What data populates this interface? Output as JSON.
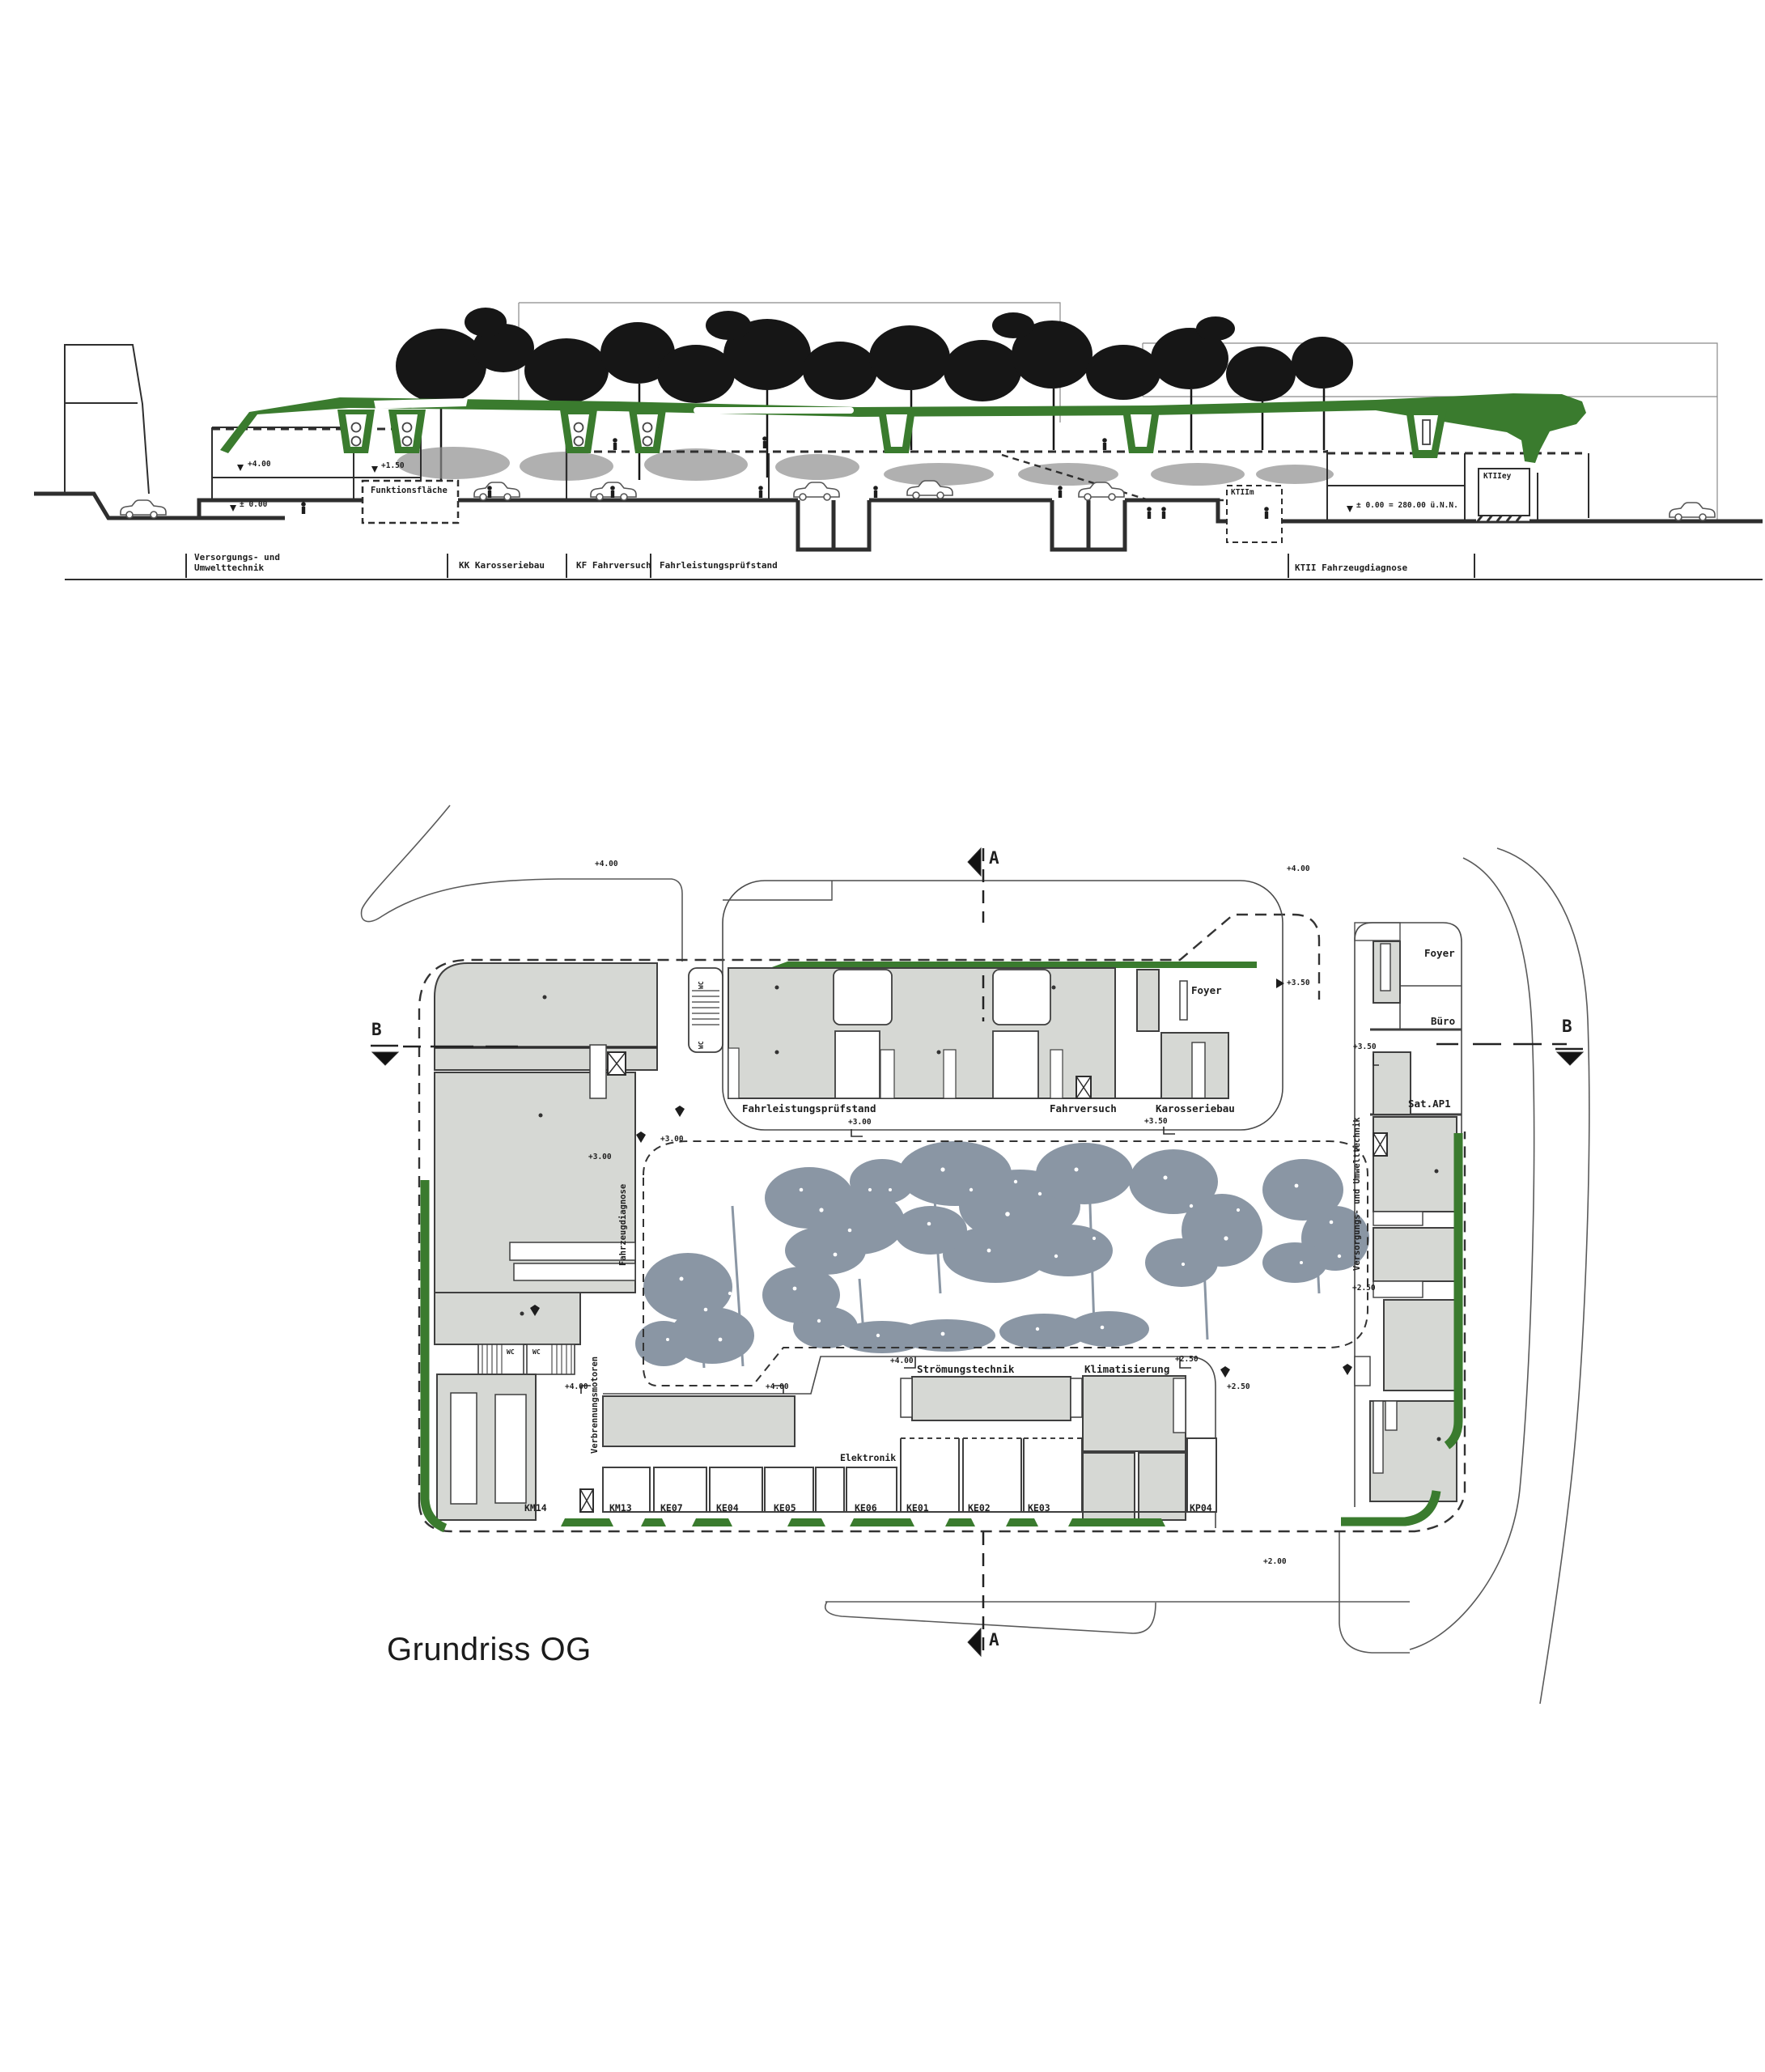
{
  "title": "Grundriss OG",
  "colors": {
    "green": "#3a7b2e",
    "building_gray": "#d6d8d4",
    "tree_gray": "#8a96a4",
    "line": "#2e2e2e"
  },
  "section": {
    "zones": [
      {
        "label": "Versorgungs- und Umwelttechnik"
      },
      {
        "label": "KK Karosseriebau"
      },
      {
        "label": "KF Fahrversuch"
      },
      {
        "label": "Fahrleistungsprüfstand"
      },
      {
        "label": "KTII Fahrzeugdiagnose"
      }
    ],
    "rooms": {
      "funktionsflaeche": "Funktionsfläche",
      "ktii_m": "KTIIm",
      "ktii_ey": "KTIIey"
    },
    "elevations": {
      "plus400": "+4.00",
      "plus150": "+1.50",
      "zero": "± 0.00",
      "datum": "± 0.00 = 280.00 ü.N.N."
    }
  },
  "plan": {
    "section_markers": {
      "a": "A",
      "b": "B"
    },
    "top_building": {
      "hall": "Fahrleistungsprüfstand",
      "fahrversuch": "Fahrversuch",
      "karosseriebau": "Karosseriebau",
      "foyer": "Foyer",
      "wc": "WC"
    },
    "right_strip": {
      "foyer": "Foyer",
      "buero": "Büro",
      "sat_ap1": "Sat.AP1",
      "versorgung": "Versorgungs- und Umwelttechnik"
    },
    "left_strip": {
      "fahrzeugdiagnose": "Fahrzeugdiagnose",
      "verbrennungsmotoren": "Verbrennungsmotoren",
      "wc": "WC",
      "km14": "KM14"
    },
    "bottom_building": {
      "stroemungstechnik": "Strömungstechnik",
      "klimatisierung": "Klimatisierung",
      "elektronik": "Elektronik"
    },
    "cells": [
      {
        "code": "KM13"
      },
      {
        "code": "KE07"
      },
      {
        "code": "KE04"
      },
      {
        "code": "KE05"
      },
      {
        "code": "KE06"
      },
      {
        "code": "KE01"
      },
      {
        "code": "KE02"
      },
      {
        "code": "KE03"
      },
      {
        "code": "KP04"
      }
    ],
    "elevations": {
      "plus400": "+4.00",
      "plus350": "+3.50",
      "plus300": "+3.00",
      "plus250": "+2.50",
      "plus200": "+2.00"
    }
  }
}
